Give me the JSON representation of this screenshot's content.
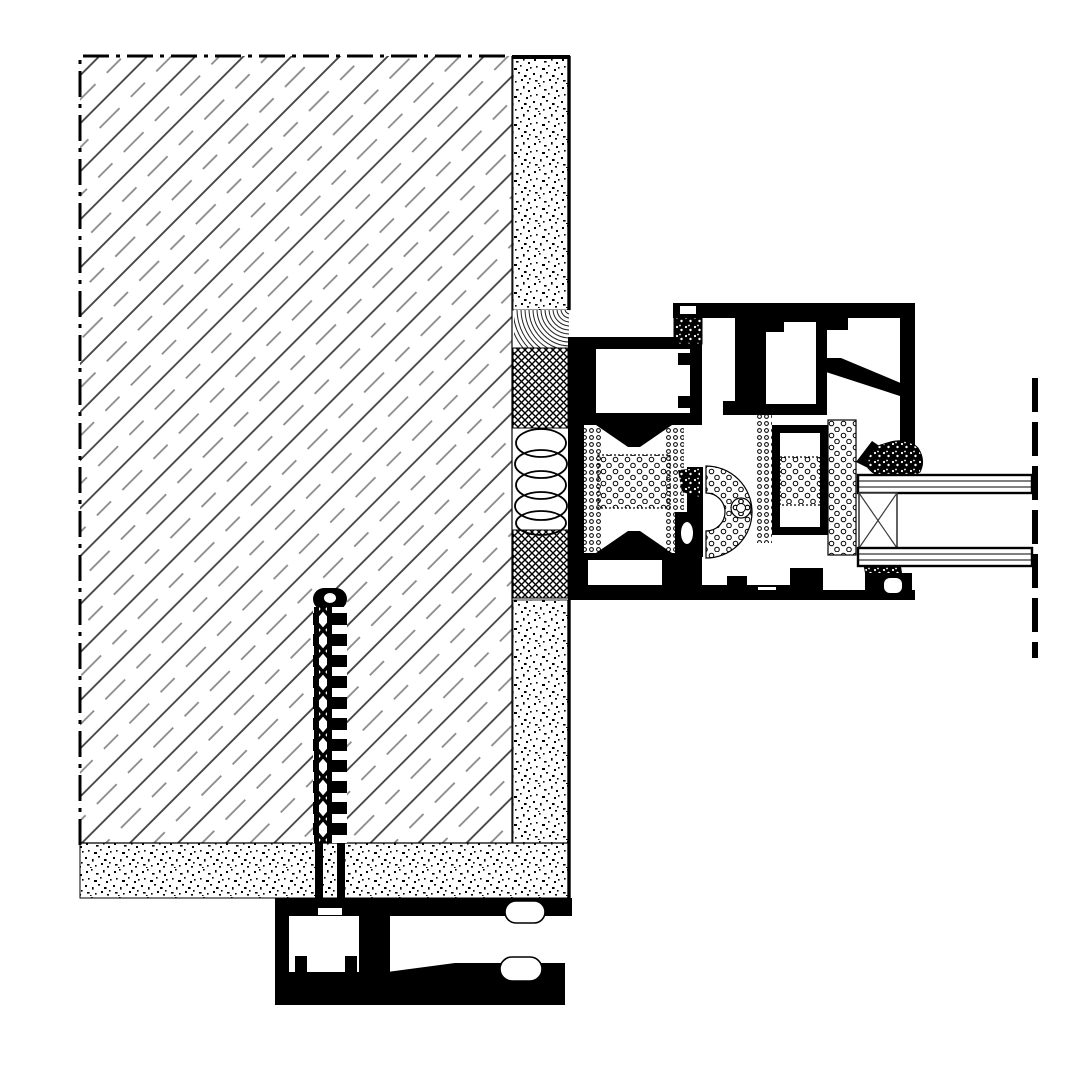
{
  "canvas": {
    "width": 1080,
    "height": 1080,
    "background": "#ffffff"
  },
  "colors": {
    "ink": "#000000",
    "paper": "#ffffff",
    "hatch_solid": "#3f3f3f",
    "hatch_broken": "#8a8a8a",
    "spacer_line": "#3a3a3a",
    "arc_hatch": "#222222"
  },
  "drawing": {
    "kind": "construction-section-detail",
    "components": [
      "masonry-wall-hatch",
      "plaster-render-layer",
      "screed-bed-layer",
      "joint-sealing-tape",
      "compriband-crosshatch-seal",
      "insulation-loop-fill",
      "threaded-anchor-screw",
      "aluminium-outer-frame-profile",
      "aluminium-sash-profile",
      "thermal-break-foam",
      "center-gasket-arc",
      "glazing-unit-double",
      "glazing-spacer",
      "glazing-gaskets",
      "sill-base-profile",
      "glass-centerline-dashed"
    ]
  }
}
